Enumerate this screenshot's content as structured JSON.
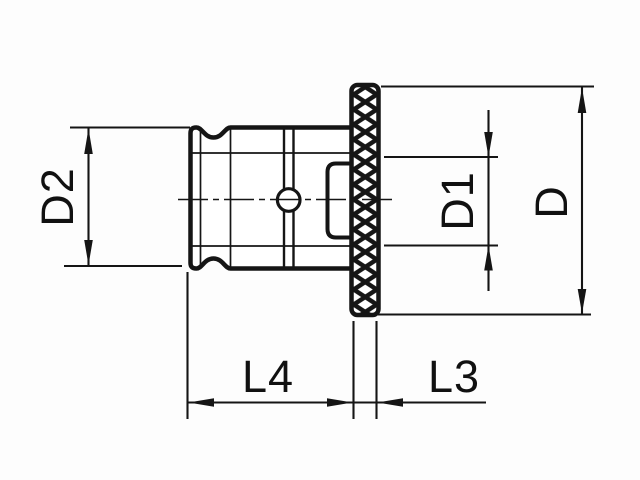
{
  "drawing": {
    "kind": "technical-drawing",
    "labels": {
      "d2": "D2",
      "d1": "D1",
      "d": "D",
      "l4": "L4",
      "l3": "L3"
    },
    "colors": {
      "line": "#151515",
      "background": "#fdfdfd",
      "fill": "#ffffff"
    }
  }
}
